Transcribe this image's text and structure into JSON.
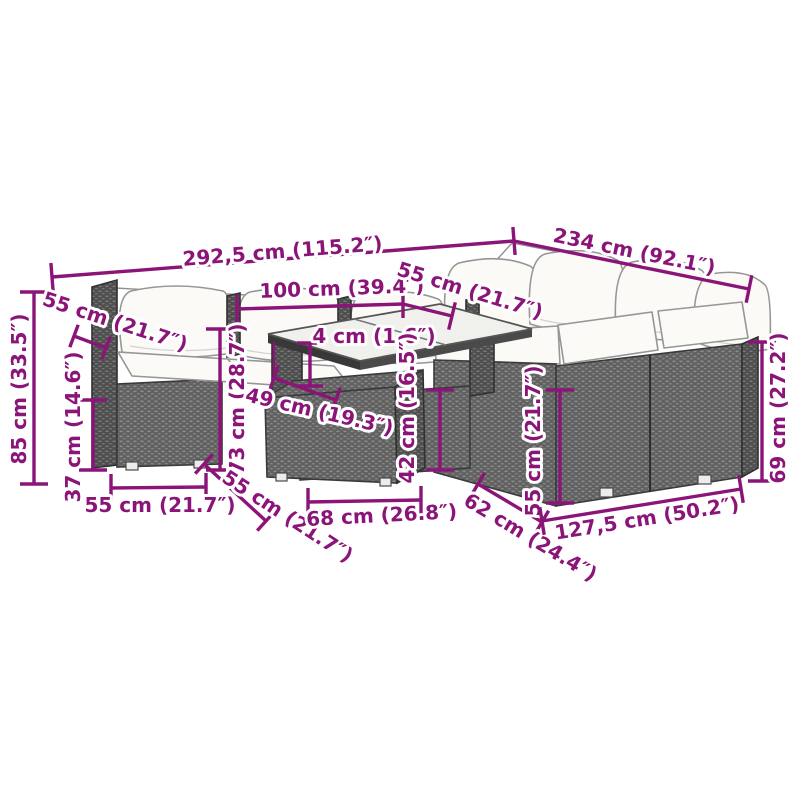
{
  "diagram": {
    "kind": "product-dimension-diagram",
    "subject": "rattan garden lounge set with cushions, glass-top table and footstool"
  },
  "colors": {
    "accent": "#8b1478",
    "cushion": "#fbfaf6",
    "background": "#ffffff",
    "wicker": "#616161",
    "wicker_dark": "#4f4f4f"
  },
  "dimensions": {
    "overall_width": "292,5 cm (115.2″)",
    "overall_depth": "234 cm (92.1″)",
    "total_height": "85 cm (33.5″)",
    "seat_depth_back_left": "55 cm (21.7″)",
    "table_length": "100 cm (39.4″)",
    "seat_depth_back_right": "55 cm (21.7″)",
    "glass_top_thickness": "4 cm (1.6″)",
    "table_height": "73 cm (28.7″)",
    "table_depth": "49 cm (19.3″)",
    "footstool_height": "42 cm (16.5″)",
    "seat_height": "37 cm (14.6″)",
    "seat_width_front_left": "55 cm (21.7″)",
    "seat_depth_front_left": "55 cm (21.7″)",
    "footstool_width": "68 cm (26.8″)",
    "module_depth_right": "62 cm (24.4″)",
    "seat_width_right": "55 cm (21.7″)",
    "right_sofa_length": "127,5 cm (50.2″)",
    "armrest_height_right": "69 cm (27.2″)"
  }
}
